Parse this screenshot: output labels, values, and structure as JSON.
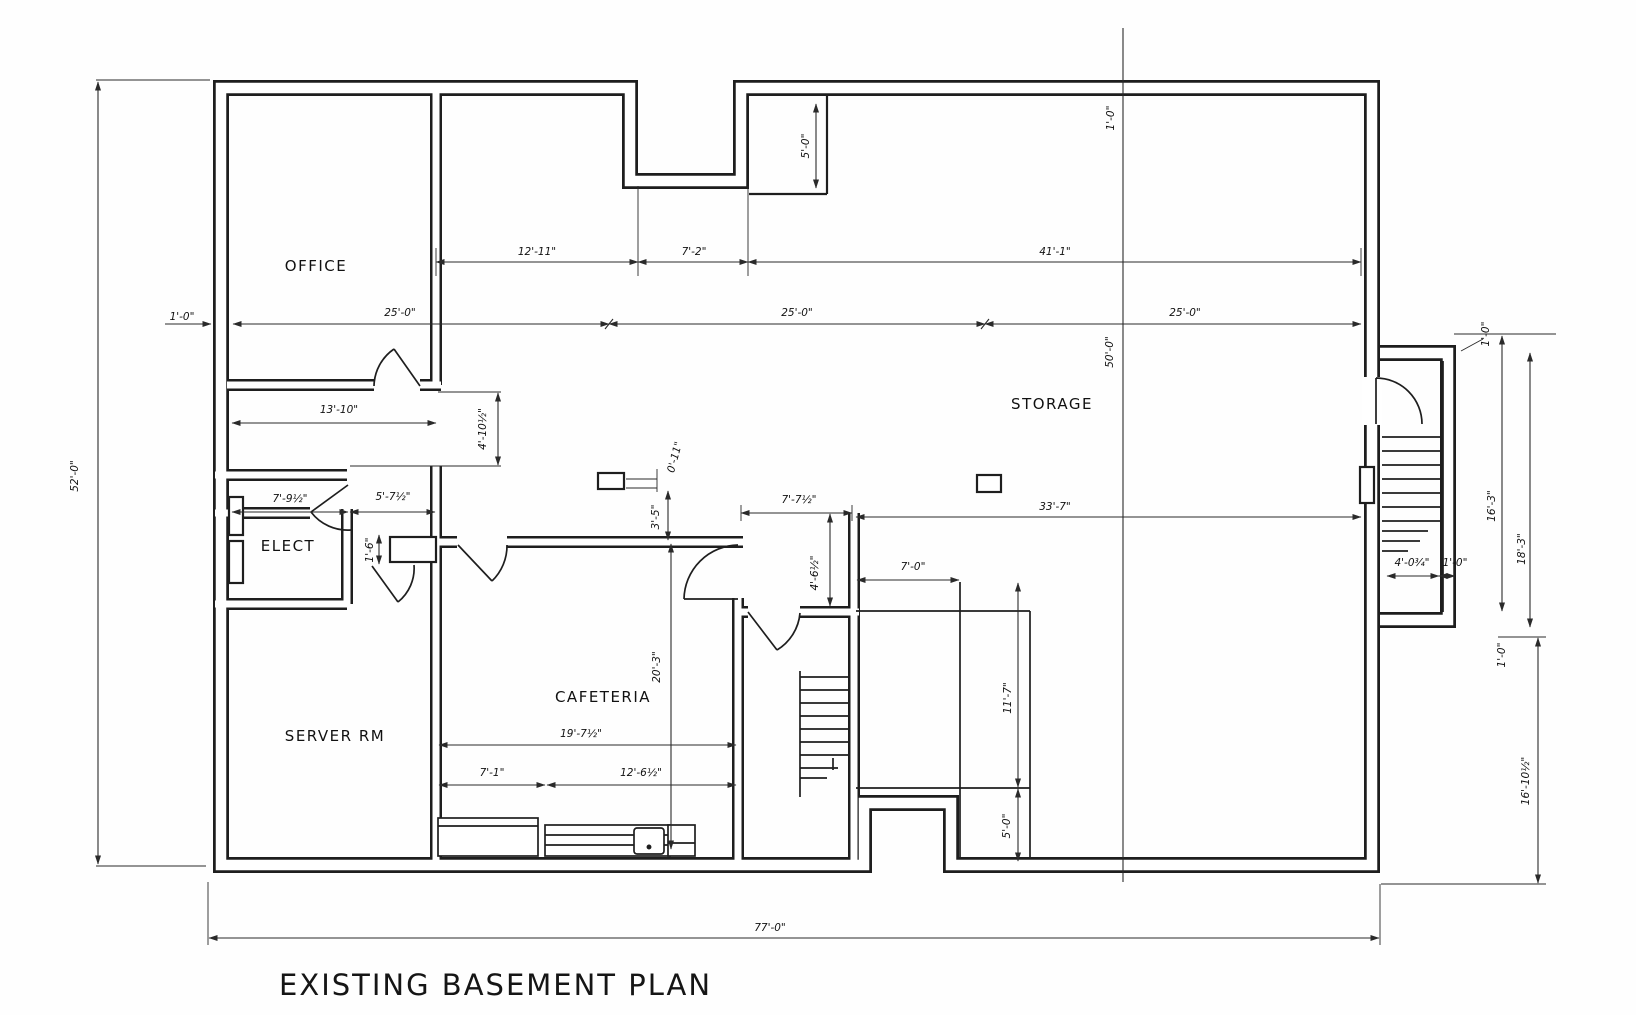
{
  "title": "EXISTING BASEMENT PLAN",
  "rooms": {
    "office": "OFFICE",
    "elect": "ELECT",
    "server_rm": "SERVER RM",
    "cafeteria": "CAFETERIA",
    "storage": "STORAGE"
  },
  "dims": {
    "bay_left": "25'-0\"",
    "bay_mid": "25'-0\"",
    "bay_right": "25'-0\"",
    "left_wall": "1'-0\"",
    "office_top": "12'-11\"",
    "notch": "7'-2\"",
    "storage_top": "41'-1\"",
    "vestibule": "5'-0\"",
    "top_wall": "1'-0\"",
    "height_total": "52'-0\"",
    "height_storage": "50'-0\"",
    "office_w": "13'-10\"",
    "hall_d": "4'-10½\"",
    "elect_w": "7'-9½\"",
    "vest_w": "5'-7½\"",
    "stub_h": "1'-6\"",
    "col_w": "0'-11\"",
    "col_gap": "3'-5\"",
    "caf_d": "20'-3\"",
    "caf_w": "19'-7½\"",
    "counter_l": "7'-1\"",
    "counter_r": "12'-6½\"",
    "stair_top": "7'-7½\"",
    "storage_mid": "33'-7\"",
    "landing_d": "4'-6½\"",
    "room_w": "7'-0\"",
    "room_h": "11'-7\"",
    "room_s": "5'-0\"",
    "ext_top_wall": "1'-0\"",
    "ext_inner_h": "16'-3\"",
    "ext_h": "18'-3\"",
    "stair_w": "4'-0¾\"",
    "stair_wall": "1'-0\"",
    "ext_bot_wall": "1'-0\"",
    "right_h": "16'-10½\"",
    "width_total": "77'-0\""
  },
  "colors": {
    "line": "#1e1e1e",
    "paper": "#fefefe"
  }
}
